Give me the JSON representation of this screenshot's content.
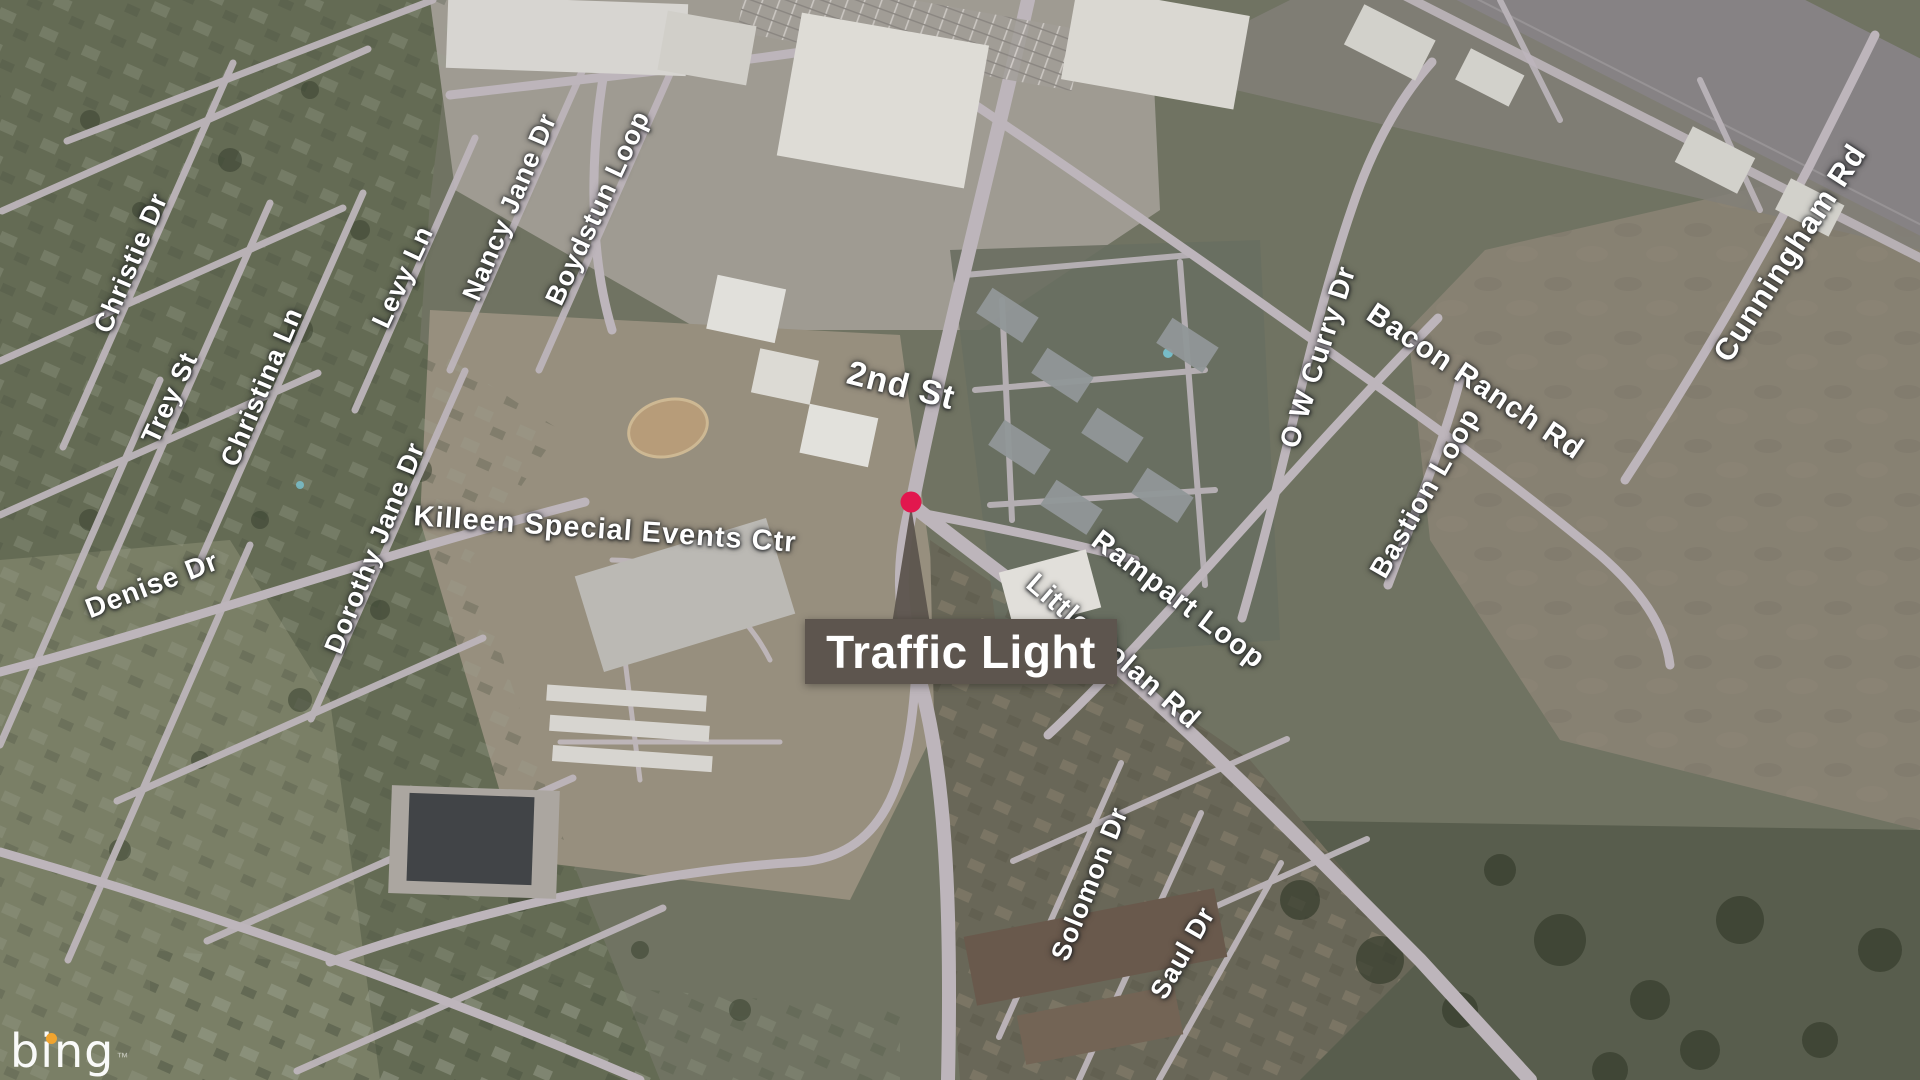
{
  "callout": {
    "label": "Traffic Light",
    "dot_color": "#e2174e",
    "pointer_color": "#5d554e",
    "box_color": "#5d554e",
    "text_color": "#ffffff"
  },
  "logo": {
    "text": "bing",
    "trademark": "™",
    "dot_color": "#f0a42f"
  },
  "labels": {
    "poi": [
      "Killeen Special Events Ctr"
    ],
    "streets": [
      "Christie Dr",
      "Trey St",
      "Christina Ln",
      "Levy Ln",
      "Nancy Jane Dr",
      "Boydstun Loop",
      "Dorothy Jane Dr",
      "Denise Dr",
      "2nd St",
      "Little Nolan Rd",
      "Rampart Loop",
      "Solomon Dr",
      "Saul Dr",
      "O W Curry Dr",
      "Bacon Ranch Rd",
      "Bastion Loop",
      "Cunningham Rd"
    ]
  },
  "palette": {
    "road": "#c8c0c5",
    "highway": "#8e8a8b",
    "residential_green": "#6a7158",
    "field_tan": "#8f8878",
    "trees_dark": "#3c4531"
  }
}
